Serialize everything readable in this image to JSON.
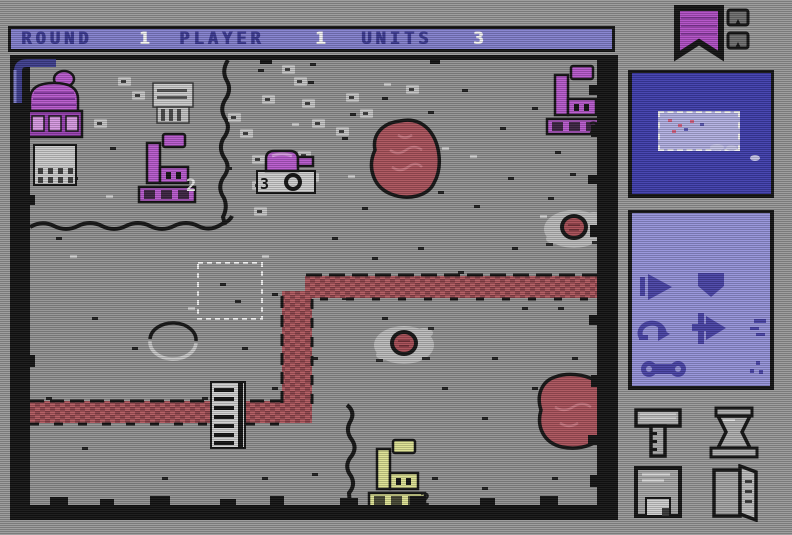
{
  "status_bar": {
    "round_label": "ROUND",
    "round_value": "1",
    "player_label": "PLAYER",
    "player_value": "1",
    "units_label": "UNITS",
    "units_value": "3"
  },
  "map": {
    "factories": {
      "northwest": {
        "count": "2",
        "owner_color": "#b85ace"
      },
      "northeast": {
        "count": "2",
        "owner_color": "#b85ace"
      },
      "south": {
        "count": "2",
        "owner_color": "#dde293"
      }
    },
    "units": {
      "tank_group": {
        "count": "3",
        "owner_color": "#b85ace"
      }
    }
  },
  "sidebar": {
    "banner_icon": "player-flag-banner",
    "mini_flags": [
      "mini-flag-1",
      "mini-flag-2"
    ],
    "minimap": {
      "description": "strategic-minimap-with-viewport"
    },
    "command_buttons": [
      "deploy",
      "shield",
      "undo",
      "move",
      "link"
    ],
    "tool_buttons": [
      "hammer-build",
      "hourglass-wait",
      "disk-save",
      "door-exit"
    ]
  },
  "colors": {
    "background": "#9a9a9a",
    "bar_bg": "#8481cf",
    "bar_label": "#3c3a92",
    "bar_value": "#f5f5f5",
    "ground": "#949494",
    "frame": "#141414",
    "river": "#b25a60",
    "river_dark": "#8f454c",
    "lake": "#ab535c",
    "crater_red": "#a84e56",
    "debris": "#bdbdbd",
    "purple": "#b85ace",
    "purple_dark": "#9a41b4",
    "yellow": "#dde293",
    "minimap_bg": "#403eae",
    "minimap_viewport": "#b3b1e4",
    "panel_bg": "#9693da",
    "panel_icon": "#4a44a8",
    "tool_gray": "#b3b3b3"
  }
}
